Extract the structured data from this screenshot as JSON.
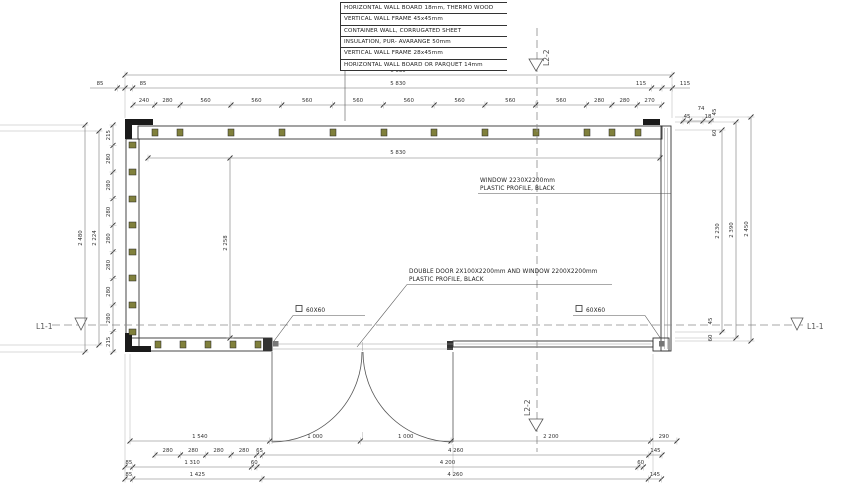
{
  "legend": {
    "rows": [
      "HORIZONTAL WALL BOARD 18mm, THERMO WOOD",
      "VERTICAL  WALL FRAME 45x45mm",
      "CONTAINER WALL, CORRUGATED SHEET",
      "INSULATION, PUR- AVARANGE 50mm",
      "VERTICAL  WALL FRAME 28x45mm",
      "HORIZONTAL WALL BOARD OR PARQUET 14mm"
    ]
  },
  "annotations": {
    "window_line1": "WINDOW 2230X2200mm",
    "window_line2": "PLASTIC PROFILE, BLACK",
    "door_line1": "DOUBLE DOOR  2X100X2200mm AND WINDOW 2200X2200mm",
    "door_line2": "PLASTIC PROFILE, BLACK",
    "post_left": "60X60",
    "post_right": "60X60"
  },
  "sections": {
    "l11": "L1-1",
    "l22": "L2-2"
  },
  "dimensions": {
    "top": {
      "total": "6 030",
      "inner": "5 830",
      "left_offsets": [
        "85",
        "85"
      ],
      "right_offsets": [
        "115",
        "115"
      ],
      "segments": [
        "240",
        "280",
        "560",
        "560",
        "560",
        "560",
        "560",
        "560",
        "560",
        "560",
        "280",
        "280",
        "270"
      ],
      "corner_small": [
        "74",
        "45",
        "18"
      ]
    },
    "left": {
      "total": "2 480",
      "inner": "2 224",
      "segments": [
        "215",
        "280",
        "280",
        "280",
        "280",
        "280",
        "280",
        "280",
        "215"
      ]
    },
    "right": {
      "lines": [
        "2 230",
        "2 390",
        "2 450"
      ],
      "top_small": [
        "45",
        "60"
      ],
      "bottom_small": [
        "45",
        "60"
      ]
    },
    "interior": {
      "width": "5 830",
      "height": "2 258"
    },
    "bottom": {
      "row1": [
        "1 540",
        "1 000",
        "1 000",
        "2 200",
        "290"
      ],
      "row2": [
        "280",
        "280",
        "280",
        "280",
        "65",
        "4 260",
        "145"
      ],
      "row3": [
        "85",
        "1 310",
        "60",
        "4 200",
        "60"
      ],
      "row4": [
        "85",
        "1 425",
        "4 260",
        "145"
      ]
    }
  }
}
